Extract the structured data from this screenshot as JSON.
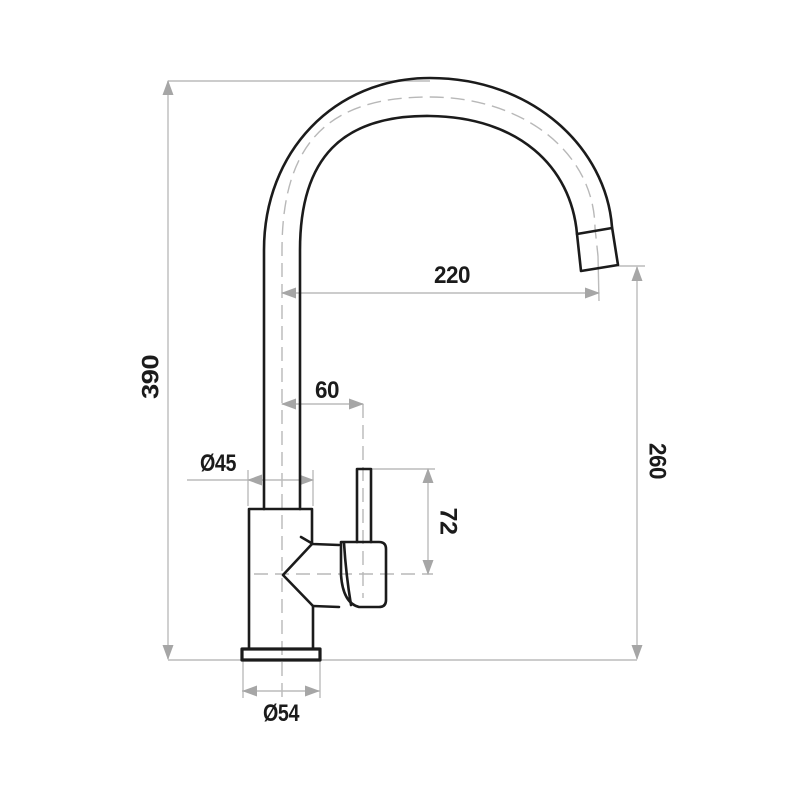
{
  "labels": {
    "overall_height": "390",
    "spout_reach": "220",
    "spout_outlet_height": "260",
    "handle_center_offset": "60",
    "body_diameter": "Ø45",
    "handle_lever_height": "72",
    "base_diameter": "Ø54"
  },
  "colors": {
    "background": "#ffffff",
    "outline": "#1b1b1b",
    "dimension_line": "#bcbcbc",
    "centerline": "#b8b8b8",
    "arrow": "#a6a6a6",
    "label_text": "#1b1b1b"
  }
}
